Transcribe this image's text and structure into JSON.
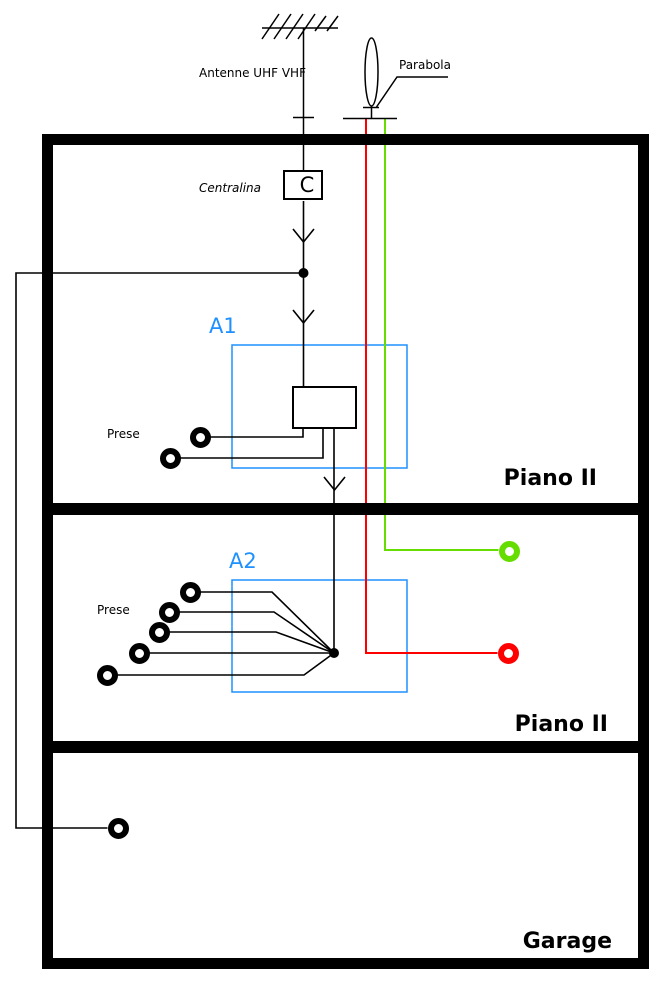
{
  "colors": {
    "accent_blue": "#1e90ff",
    "cable_red": "#ff0000",
    "cable_green": "#66dd00",
    "line_black": "#000000"
  },
  "antenna": {
    "label": "Antenne UHF VHF"
  },
  "parabola": {
    "label": "Parabola"
  },
  "centralina": {
    "label": "Centralina",
    "box_letter": "C"
  },
  "amplifiers": [
    {
      "id": "A1",
      "prese_label": "Prese",
      "outlet_count": 2
    },
    {
      "id": "A2",
      "prese_label": "Prese",
      "outlet_count": 5
    }
  ],
  "floors": [
    {
      "label": "Piano II"
    },
    {
      "label": "Piano II"
    },
    {
      "label": "Garage"
    }
  ],
  "outlets": [
    {
      "name": "outlet-a1-1",
      "cx": 200,
      "cy": 437,
      "color": "#000000"
    },
    {
      "name": "outlet-a1-2",
      "cx": 170,
      "cy": 458,
      "color": "#000000"
    },
    {
      "name": "outlet-a2-1",
      "cx": 190,
      "cy": 592,
      "color": "#000000"
    },
    {
      "name": "outlet-a2-2",
      "cx": 169,
      "cy": 612,
      "color": "#000000"
    },
    {
      "name": "outlet-a2-3",
      "cx": 159,
      "cy": 632,
      "color": "#000000"
    },
    {
      "name": "outlet-a2-4",
      "cx": 139,
      "cy": 653,
      "color": "#000000"
    },
    {
      "name": "outlet-a2-5",
      "cx": 107,
      "cy": 675,
      "color": "#000000"
    },
    {
      "name": "outlet-sat-green",
      "cx": 509,
      "cy": 551,
      "color": "#66dd00"
    },
    {
      "name": "outlet-sat-red",
      "cx": 508,
      "cy": 653,
      "color": "#ff0000"
    },
    {
      "name": "outlet-garage",
      "cx": 118,
      "cy": 828,
      "color": "#000000"
    }
  ]
}
